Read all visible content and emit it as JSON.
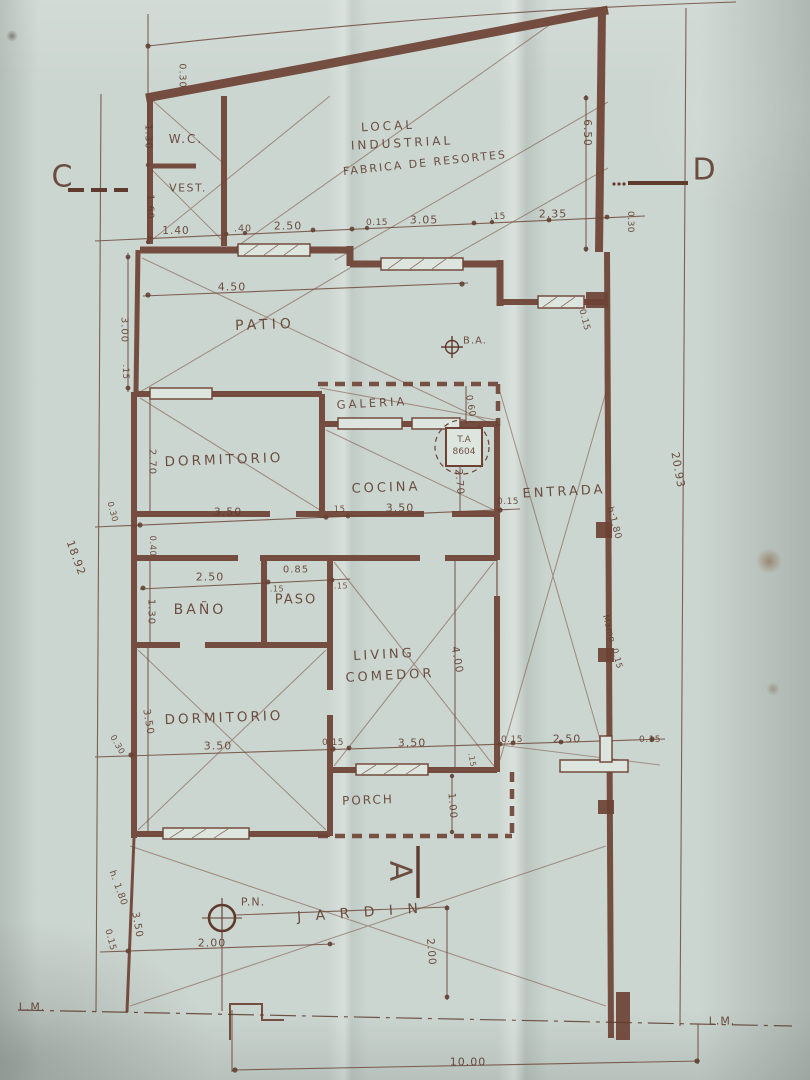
{
  "plan": {
    "title_block": {
      "building_use_line1": "LOCAL",
      "building_use_line2": "INDUSTRIAL",
      "building_use_line3": "FABRICA DE RESORTES"
    },
    "rooms": {
      "wc": "W.C.",
      "vest": "VEST.",
      "patio": "PATIO",
      "galeria": "GALERIA",
      "dormitorio_1": "DORMITORIO",
      "cocina": "COCINA",
      "entrada": "ENTRADA",
      "bano": "BAÑO",
      "paso": "PASO",
      "living_line1": "LIVING",
      "living_line2": "COMEDOR",
      "dormitorio_2": "DORMITORIO",
      "porch": "PORCH",
      "jardin": "J A R D I N"
    },
    "sections": {
      "c": "C",
      "d": "D",
      "a": "A"
    },
    "symbols": {
      "ba": "B.A.",
      "pn": "P.N.",
      "ta_line1": "T.A",
      "ta_line2": "8604"
    },
    "property_lines": {
      "lm_left": "L.M.",
      "lm_right": "L.M."
    },
    "dimensions": {
      "top_left_030": "0.30",
      "wc_height": "1.30",
      "vest_height": "1.60",
      "vest_width": "1.40",
      "front_040": ".40",
      "front_250": "2.50",
      "front_015a": "0.15",
      "local_305": "3.05",
      "front_015b": ".15",
      "local_235": "2.35",
      "right_030": "0.30",
      "local_height": "6.50",
      "patio_width": "4.50",
      "patio_height": "3.00",
      "patio_015": ".15",
      "entry_015": "0.15",
      "galeria_060": "0.60",
      "dorm1_height": "2.70",
      "dorm1_width": "3.50",
      "mid_015": ".15",
      "cocina_width": "3.50",
      "cocina_015": "0.15",
      "cocina_height": "2.70",
      "left_030": "0.30",
      "left_040": "0.40",
      "bano_width": "2.50",
      "paso_width": "0.85",
      "paso_015a": ".15",
      "paso_015b": ".15",
      "bano_height": "1.30",
      "living_height": "4.00",
      "door_height": "h:1.80",
      "wall_mamposteria": "Mamp. 0.15",
      "lot_depth_right": "20.93",
      "lot_depth_left": "18.92",
      "bottom_030": "0.30",
      "dorm2_width": "3.50",
      "bottom_015a": "0.15",
      "living_width": "3.50",
      "step_015": ".15",
      "bottom_015b": "0.15",
      "gate_width": "2.50",
      "bottom_015c": "0.15",
      "dorm2_height": "3.50",
      "porch_height": "1.00",
      "fence_height": "h. 1.80",
      "fence_015": "0.15",
      "jardin_left_350": "3.50",
      "pn_offset_x": "2.00",
      "pn_offset_y": "2.00",
      "lot_width": "10.00"
    },
    "colors": {
      "ink": "#5e3b2d",
      "wall": "#6d4234",
      "paper": "#ccd6d0"
    }
  }
}
